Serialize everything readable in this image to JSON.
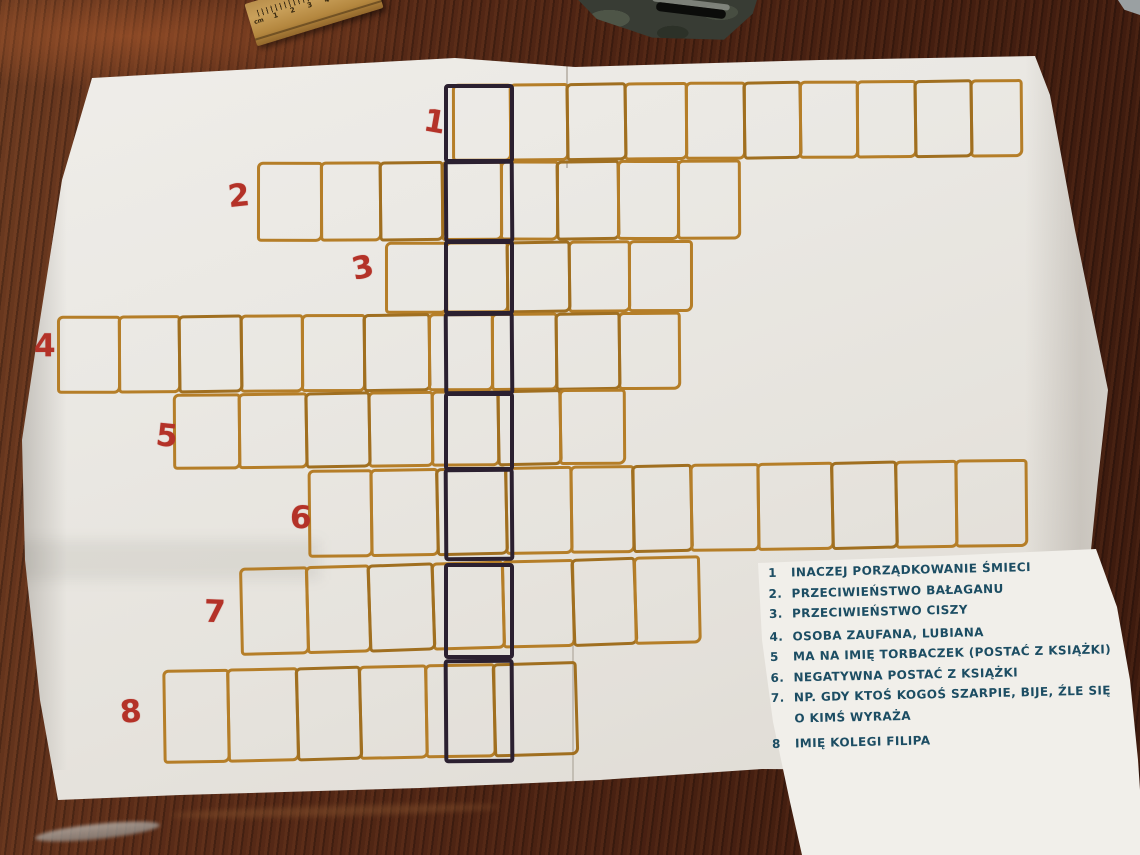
{
  "colors": {
    "grid_orange": "#b57e28",
    "grid_orange_dark": "#a06f20",
    "answer_column_dark": "#2b2030",
    "row_number_red": "#b43228",
    "clue_ink_blue": "#1c4d63",
    "desk_wood": "#4e2616",
    "paper": "#eae8e3",
    "clue_sheet_paper": "#f1efea",
    "ruler_wood": "#c9a05a"
  },
  "ruler": {
    "unit": "cm",
    "numbers": [
      "1",
      "2",
      "3",
      "4",
      "5"
    ]
  },
  "crossword": {
    "answer_column": {
      "x": [
        444,
        514
      ],
      "cells_y": [
        [
          84,
          163
        ],
        [
          160,
          243
        ],
        [
          240,
          315
        ],
        [
          312,
          395
        ],
        [
          392,
          471
        ],
        [
          468,
          561
        ],
        [
          563,
          659
        ],
        [
          659,
          763
        ]
      ]
    },
    "rows": [
      {
        "number": "1",
        "cells": 10,
        "dark_cell": 1,
        "x": [
          452,
          512,
          572,
          633,
          697,
          758,
          817,
          877,
          938,
          997,
          1050
        ],
        "y": [
          84,
          162
        ],
        "tilt": -0.5,
        "num_pos": [
          424,
          104
        ],
        "num_tilt": 10
      },
      {
        "number": "2",
        "cells": 8,
        "dark_cell": 4,
        "x": [
          257,
          323,
          385,
          450,
          512,
          571,
          635,
          698,
          762
        ],
        "y": [
          162,
          242
        ],
        "tilt": -0.3,
        "num_pos": [
          228,
          178
        ],
        "num_tilt": -6
      },
      {
        "number": "3",
        "cells": 5,
        "dark_cell": 2,
        "x": [
          385,
          448,
          512,
          577,
          640,
          705
        ],
        "y": [
          242,
          314
        ],
        "tilt": -0.4,
        "num_pos": [
          352,
          250
        ],
        "num_tilt": -12
      },
      {
        "number": "4",
        "cells": 10,
        "dark_cell": 7,
        "x": [
          57,
          121,
          184,
          249,
          313,
          378,
          446,
          512,
          579,
          645,
          708
        ],
        "y": [
          316,
          394
        ],
        "tilt": -0.4,
        "num_pos": [
          34,
          328
        ],
        "num_tilt": 0
      },
      {
        "number": "5",
        "cells": 7,
        "dark_cell": 5,
        "x": [
          173,
          241,
          311,
          377,
          443,
          512,
          577,
          644
        ],
        "y": [
          394,
          470
        ],
        "tilt": -0.7,
        "num_pos": [
          156,
          418
        ],
        "num_tilt": 6
      },
      {
        "number": "6",
        "cells": 11,
        "dark_cell": 3,
        "x": [
          308,
          373,
          442,
          514,
          582,
          647,
          708,
          778,
          855,
          922,
          985,
          1058
        ],
        "y": [
          470,
          558
        ],
        "tilt": -0.9,
        "num_pos": [
          290,
          500
        ],
        "num_tilt": 0
      },
      {
        "number": "7",
        "cells": 7,
        "dark_cell": 4,
        "x": [
          240,
          309,
          374,
          441,
          514,
          587,
          652,
          719
        ],
        "y": [
          568,
          656
        ],
        "tilt": -1.6,
        "num_pos": [
          204,
          594
        ],
        "num_tilt": 2
      },
      {
        "number": "8",
        "cells": 6,
        "dark_cell": 5,
        "x": [
          163,
          230,
          302,
          368,
          437,
          508,
          593
        ],
        "y": [
          670,
          764
        ],
        "tilt": -1.2,
        "num_pos": [
          120,
          694
        ],
        "num_tilt": -5
      }
    ]
  },
  "clues": {
    "items": [
      {
        "label": "1",
        "text": "INACZEJ PORZĄDKOWANIE ŚMIECI"
      },
      {
        "label": "2.",
        "text": "PRZECIWIEŃSTWO BAŁAGANU"
      },
      {
        "label": "3.",
        "text": "PRZECIWIEŃSTWO CISZY"
      },
      {
        "label": "4.",
        "text": "OSOBA ZAUFANA, LUBIANA"
      },
      {
        "label": "5",
        "text": "MA NA IMIĘ TORBACZEK (POSTAĆ Z KSIĄŻKI)"
      },
      {
        "label": "6.",
        "text": "NEGATYWNA POSTAĆ Z KSIĄŻKI"
      },
      {
        "label": "7.",
        "text": "NP. GDY KTOŚ KOGOŚ SZARPIE, BIJE, ŹLE SIĘ\nO KIMŚ WYRAŻA"
      },
      {
        "label": "8",
        "text": "IMIĘ KOLEGI FILIPA"
      }
    ]
  }
}
